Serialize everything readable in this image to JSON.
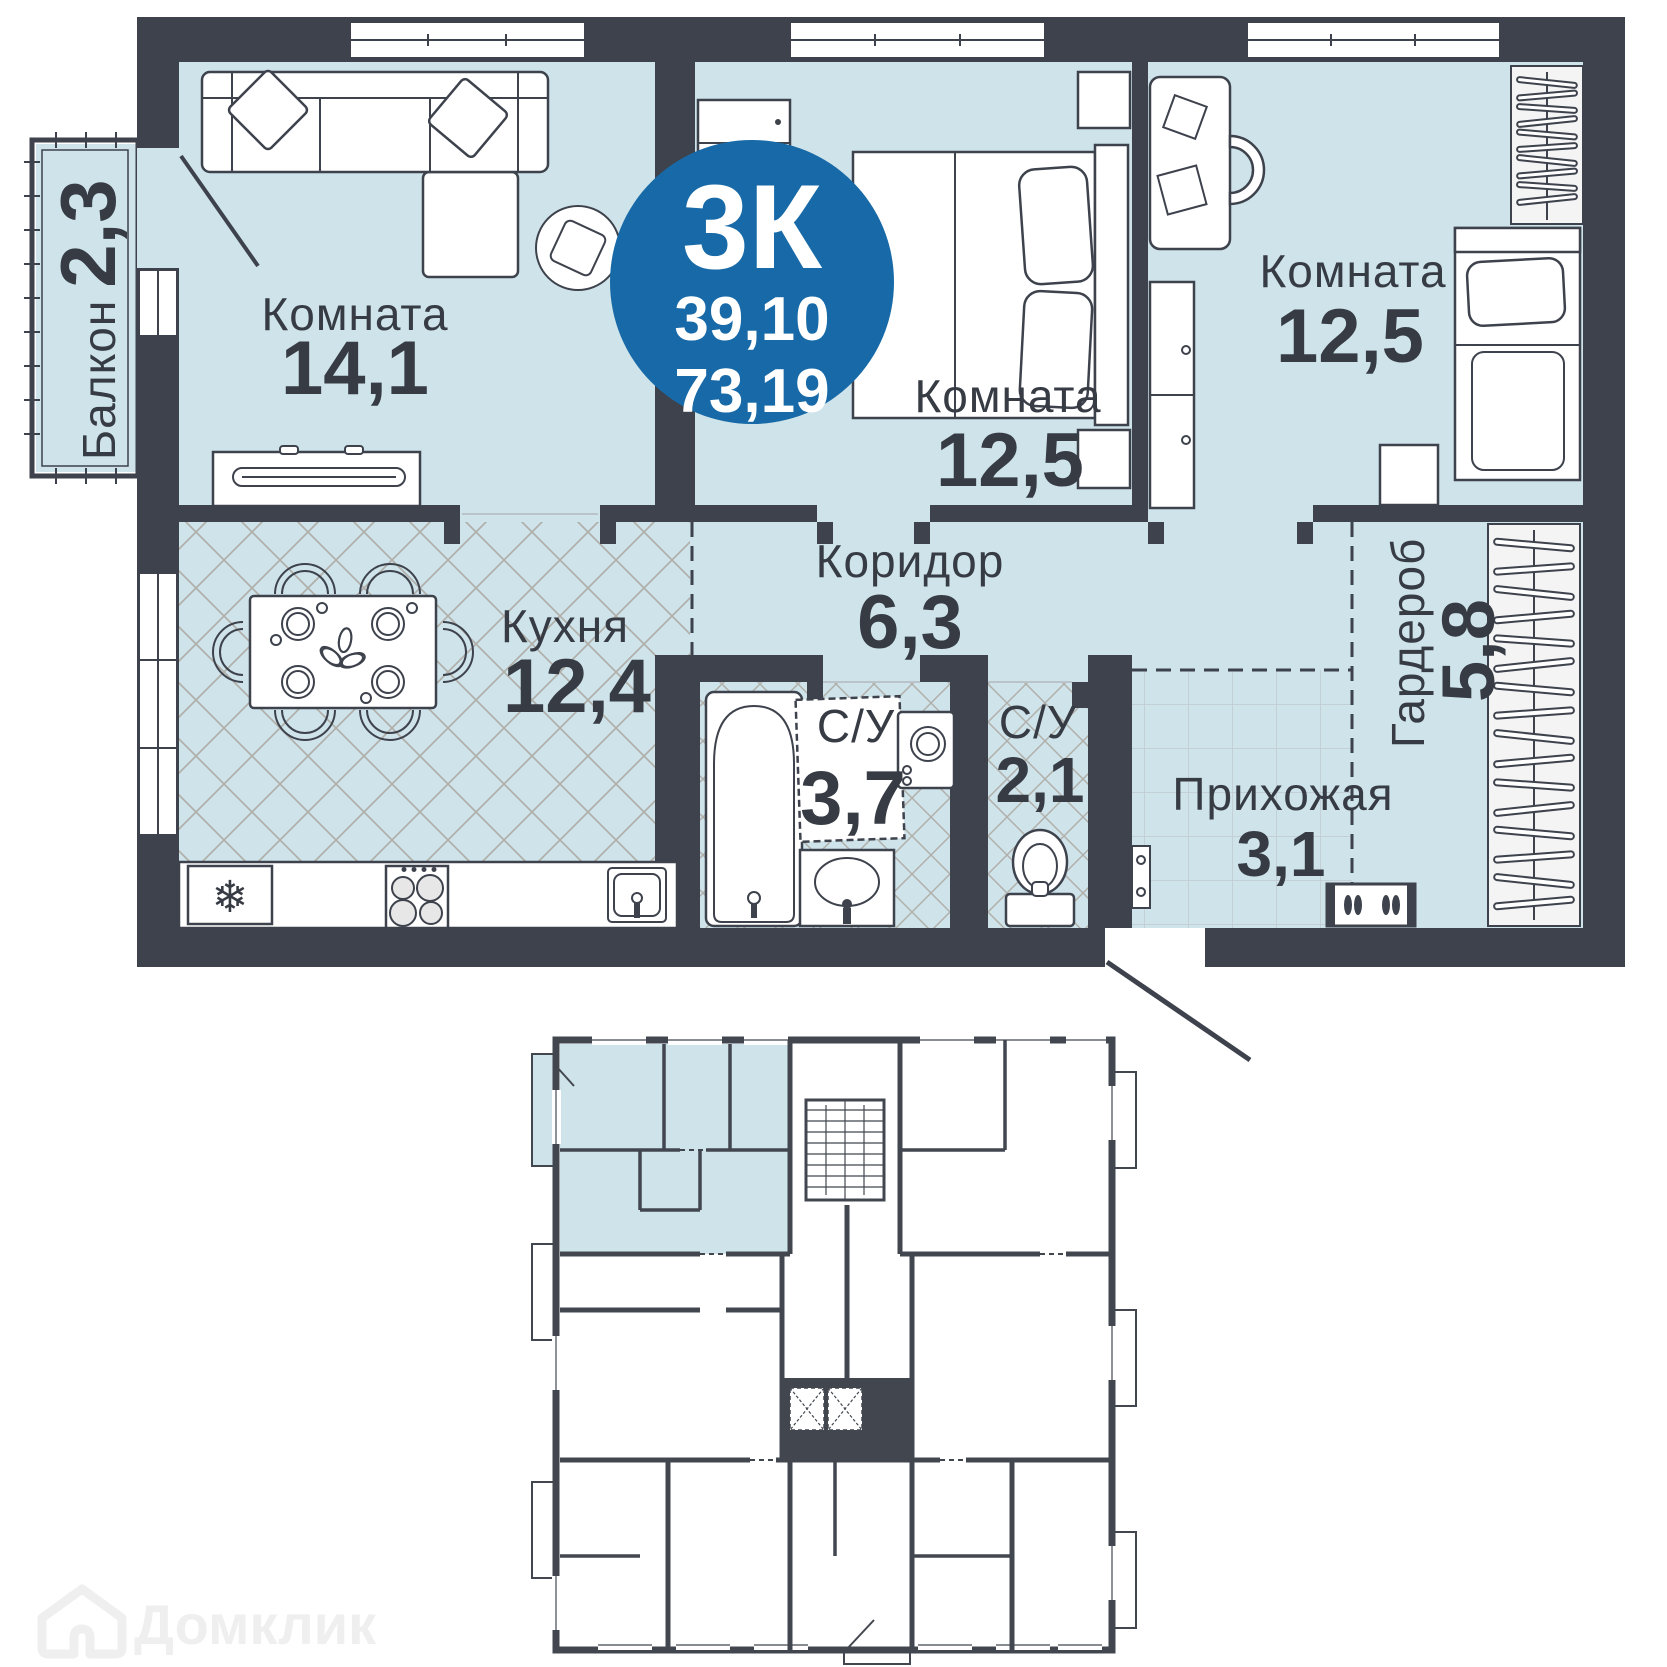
{
  "badge": {
    "type": "3К",
    "area_living": "39,10",
    "area_total": "73,19"
  },
  "rooms": {
    "living": {
      "name": "Комната",
      "area": "14,1"
    },
    "bedroom_mid": {
      "name": "Комната",
      "area": "12,5"
    },
    "bedroom_right": {
      "name": "Комната",
      "area": "12,5"
    },
    "kitchen": {
      "name": "Кухня",
      "area": "12,4"
    },
    "corridor": {
      "name": "Коридор",
      "area": "6,3"
    },
    "bathroom": {
      "name": "С/У",
      "area": "3,7"
    },
    "toilet": {
      "name": "С/У",
      "area": "2,1"
    },
    "hallway": {
      "name": "Прихожая",
      "area": "3,1"
    },
    "wardrobe": {
      "name": "Гардероб",
      "area": "5,8"
    },
    "balcony": {
      "name": "Балкон",
      "area": "2,3"
    }
  },
  "watermark": {
    "brand": "Домклик"
  },
  "colors": {
    "wall": "#3D424C",
    "floor": "#CFE3EA",
    "badge_blue": "#176AA7",
    "text": "#363B44",
    "lattice": "#B0AFA9",
    "tile": "#BFC9CE"
  }
}
